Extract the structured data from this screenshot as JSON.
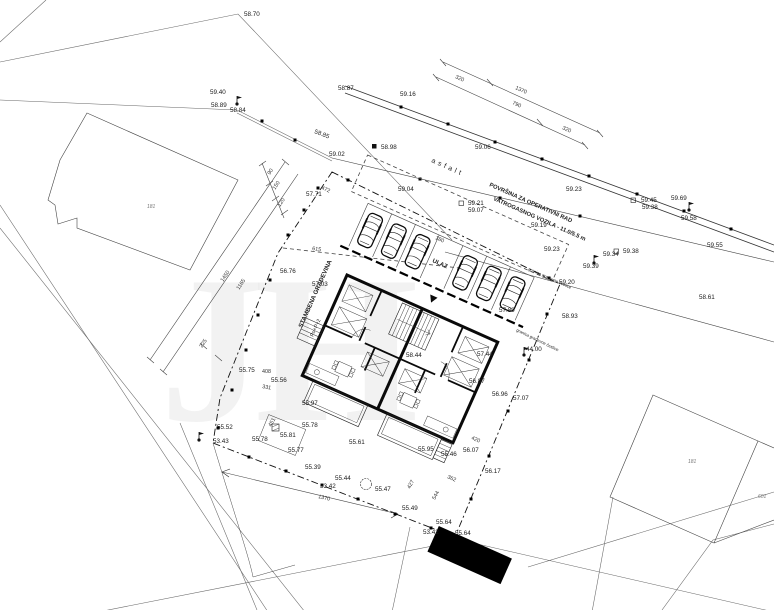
{
  "watermark": "JH",
  "legend": {
    "entrance": "ULAZ",
    "surface_note_line1": "POVRŠINA ZA OPERATIVNI RAD",
    "surface_note_line2": "VATROGASNOG VOZILA - 11.0/5.5 m",
    "building_use": "STAMBENA GRAĐEVINA",
    "building_floors": "Po+P+2",
    "pavement": "asfalt",
    "boundary_note": "granica građevne čestice"
  },
  "labels": {
    "elevations": [
      {
        "t": "58.70",
        "x": 244,
        "y": 16
      },
      {
        "t": "59.40",
        "x": 210,
        "y": 94
      },
      {
        "t": "58.89",
        "x": 211,
        "y": 107
      },
      {
        "t": "58.84",
        "x": 230,
        "y": 112
      },
      {
        "t": "58.87",
        "x": 338,
        "y": 90
      },
      {
        "t": "59.16",
        "x": 400,
        "y": 96
      },
      {
        "t": "59.06",
        "x": 475,
        "y": 149
      },
      {
        "t": "58.98",
        "x": 381,
        "y": 149
      },
      {
        "t": "59.02",
        "x": 329,
        "y": 156
      },
      {
        "t": "57.71",
        "x": 306,
        "y": 196
      },
      {
        "t": "59.04",
        "x": 398,
        "y": 191
      },
      {
        "t": "59.21",
        "x": 468,
        "y": 205
      },
      {
        "t": "59.07",
        "x": 468,
        "y": 212
      },
      {
        "t": "59.19",
        "x": 531,
        "y": 227
      },
      {
        "t": "59.23",
        "x": 566,
        "y": 191
      },
      {
        "t": "59.23",
        "x": 544,
        "y": 251
      },
      {
        "t": "59.45",
        "x": 641,
        "y": 202
      },
      {
        "t": "59.38",
        "x": 642,
        "y": 209
      },
      {
        "t": "59.69",
        "x": 671,
        "y": 200
      },
      {
        "t": "59.58",
        "x": 681,
        "y": 220
      },
      {
        "t": "59.55",
        "x": 707,
        "y": 247
      },
      {
        "t": "58.61",
        "x": 699,
        "y": 299
      },
      {
        "t": "59.34",
        "x": 603,
        "y": 256
      },
      {
        "t": "59.38",
        "x": 623,
        "y": 253
      },
      {
        "t": "59.39",
        "x": 583,
        "y": 268
      },
      {
        "t": "59.20",
        "x": 559,
        "y": 284
      },
      {
        "t": "58.93",
        "x": 562,
        "y": 318
      },
      {
        "t": "57.89",
        "x": 499,
        "y": 312
      },
      {
        "t": "44.00",
        "x": 526,
        "y": 351
      },
      {
        "t": "56.76",
        "x": 280,
        "y": 273
      },
      {
        "t": "57.03",
        "x": 312,
        "y": 286
      },
      {
        "t": "55.75",
        "x": 239,
        "y": 372
      },
      {
        "t": "55.56",
        "x": 271,
        "y": 382
      },
      {
        "t": "55.97",
        "x": 302,
        "y": 405
      },
      {
        "t": "55.52",
        "x": 217,
        "y": 429
      },
      {
        "t": "53.43",
        "x": 213,
        "y": 443
      },
      {
        "t": "55.78",
        "x": 252,
        "y": 441
      },
      {
        "t": "55.81",
        "x": 280,
        "y": 437
      },
      {
        "t": "55.78",
        "x": 302,
        "y": 427
      },
      {
        "t": "55.77",
        "x": 288,
        "y": 452
      },
      {
        "t": "55.39",
        "x": 305,
        "y": 469
      },
      {
        "t": "55.44",
        "x": 335,
        "y": 480
      },
      {
        "t": "53.42",
        "x": 320,
        "y": 488
      },
      {
        "t": "55.47",
        "x": 375,
        "y": 491
      },
      {
        "t": "55.61",
        "x": 349,
        "y": 444
      },
      {
        "t": "55.95",
        "x": 418,
        "y": 451
      },
      {
        "t": "55.46",
        "x": 441,
        "y": 456
      },
      {
        "t": "56.07",
        "x": 463,
        "y": 452
      },
      {
        "t": "55.49",
        "x": 402,
        "y": 510
      },
      {
        "t": "55.64",
        "x": 436,
        "y": 524
      },
      {
        "t": "53.42",
        "x": 423,
        "y": 534
      },
      {
        "t": "55.64",
        "x": 455,
        "y": 535
      },
      {
        "t": "56.17",
        "x": 485,
        "y": 473
      },
      {
        "t": "56.96",
        "x": 492,
        "y": 396
      },
      {
        "t": "57.07",
        "x": 513,
        "y": 400
      },
      {
        "t": "57.44",
        "x": 477,
        "y": 356
      },
      {
        "t": "58.44",
        "x": 406,
        "y": 357
      },
      {
        "t": "56.87",
        "x": 469,
        "y": 383
      }
    ],
    "dimensions": [
      {
        "t": "320",
        "x": 455,
        "y": 78,
        "r": 24
      },
      {
        "t": "1370",
        "x": 515,
        "y": 89,
        "r": 24
      },
      {
        "t": "790",
        "x": 512,
        "y": 104,
        "r": 24
      },
      {
        "t": "320",
        "x": 562,
        "y": 129,
        "r": 24
      },
      {
        "t": "1450",
        "x": 223,
        "y": 282,
        "r": -56
      },
      {
        "t": "1165",
        "x": 239,
        "y": 290,
        "r": -56
      },
      {
        "t": "225",
        "x": 202,
        "y": 348,
        "r": -56
      },
      {
        "t": "90",
        "x": 270,
        "y": 175,
        "r": -56
      },
      {
        "t": "150",
        "x": 275,
        "y": 190,
        "r": -56
      },
      {
        "t": "120",
        "x": 280,
        "y": 207,
        "r": -56
      },
      {
        "t": "472",
        "x": 321,
        "y": 189,
        "r": 24
      },
      {
        "t": "615",
        "x": 312,
        "y": 250,
        "r": 8
      },
      {
        "t": "180",
        "x": 435,
        "y": 239,
        "r": 24
      },
      {
        "t": "408",
        "x": 262,
        "y": 373,
        "r": 0
      },
      {
        "t": "331",
        "x": 262,
        "y": 388,
        "r": 10
      },
      {
        "t": "451",
        "x": 271,
        "y": 427,
        "r": -60
      },
      {
        "t": "1370",
        "x": 318,
        "y": 498,
        "r": 13
      },
      {
        "t": "420",
        "x": 471,
        "y": 439,
        "r": 24
      },
      {
        "t": "362",
        "x": 447,
        "y": 478,
        "r": 24
      },
      {
        "t": "427",
        "x": 410,
        "y": 489,
        "r": -62
      },
      {
        "t": "544",
        "x": 435,
        "y": 500,
        "r": -62
      }
    ],
    "annotations": [
      {
        "t": "asfalt",
        "x": 431,
        "y": 162,
        "r": 24,
        "s": 7,
        "ls": 3,
        "c": "#444"
      },
      {
        "t": "POVRŠINA ZA OPERATIVNI RAD",
        "x": 489,
        "y": 186,
        "r": 24,
        "s": 5.8,
        "b": 1
      },
      {
        "t": "VATROGASNOG VOZILA - 11.0/5.5 m",
        "x": 493,
        "y": 200,
        "r": 24,
        "s": 5.8,
        "b": 1
      },
      {
        "t": "STAMBENA GRAĐEVINA",
        "x": 302,
        "y": 328,
        "r": -66,
        "s": 6.2,
        "b": 1
      },
      {
        "t": "Po+P+2",
        "x": 313,
        "y": 337,
        "r": -66,
        "s": 5.2
      },
      {
        "t": "ULAZ",
        "x": 432,
        "y": 262,
        "r": 24,
        "s": 6,
        "b": 1
      },
      {
        "t": "granica građevne čestice",
        "x": 528,
        "y": 270,
        "r": 24,
        "s": 4.2,
        "c": "#555"
      },
      {
        "t": "granica građevne čestice",
        "x": 516,
        "y": 331,
        "r": 26,
        "s": 4.2,
        "c": "#555"
      },
      {
        "t": "58.85",
        "x": 314,
        "y": 133,
        "r": 21,
        "s": 6.2
      }
    ],
    "parcels": [
      {
        "t": "181",
        "x": 147,
        "y": 208
      },
      {
        "t": "181",
        "x": 688,
        "y": 463
      },
      {
        "t": "601",
        "x": 758,
        "y": 498
      }
    ]
  }
}
